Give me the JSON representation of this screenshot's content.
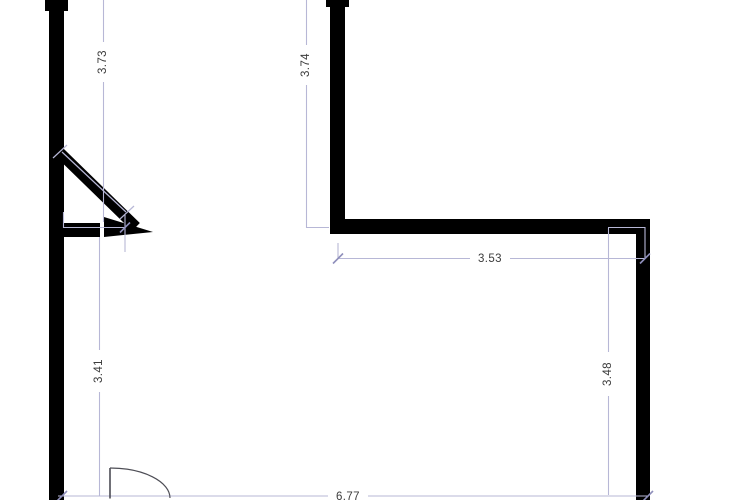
{
  "page": {
    "background_color": "#ffffff"
  },
  "drawing": {
    "type": "floor-plan",
    "wall_color": "#000000",
    "dimension_line_color": "#b7b7d6",
    "dimension_tick_color": "#8f8fbb",
    "dimension_text_color": "#3c3c3c",
    "door_symbol_color": "#4d4d55",
    "dimensions": {
      "upper_left_height": "3.73",
      "upper_mid_height": "3.74",
      "upper_right_width": "3.53",
      "lower_left_height": "3.41",
      "lower_right_height": "3.48",
      "bottom_width": "6.77"
    }
  }
}
